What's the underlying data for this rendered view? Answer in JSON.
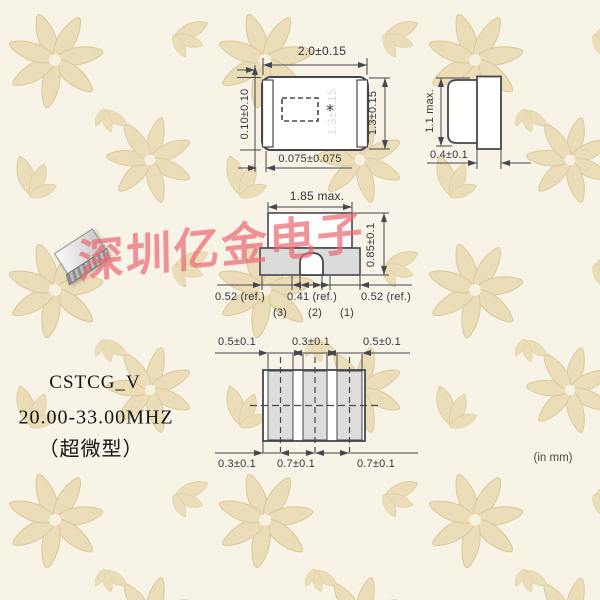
{
  "watermark": {
    "text": "深圳亿金电子",
    "color": "#eb6974"
  },
  "product": {
    "model": "CSTCG_V",
    "frequency": "20.00-33.00MHZ",
    "type_label": "（超微型）"
  },
  "units_note": "(in mm)",
  "top_view": {
    "width": "2.0±0.15",
    "electrode": "0.10±0.10",
    "height": "1.3±0.15",
    "offset": "0.075±0.075",
    "ghost_label": "1.3±0.15",
    "polarity_mark": "*"
  },
  "side_view": {
    "height": "1.1 max.",
    "cap_width": "0.4±0.1"
  },
  "front_view": {
    "width": "1.85 max.",
    "height": "0.85±0.1",
    "pad_left": "0.52 (ref.)",
    "pad_center": "0.41 (ref.)",
    "pad_right": "0.52 (ref.)",
    "pin3": "(3)",
    "pin2": "(2)",
    "pin1": "(1)"
  },
  "land_pattern": {
    "top_left": "0.5±0.1",
    "top_center": "0.3±0.1",
    "top_right": "0.5±0.1",
    "bottom_left": "0.3±0.1",
    "bottom_center": "0.7±0.1",
    "bottom_right": "0.7±0.1"
  },
  "colors": {
    "line": "#46464e",
    "pad_fill": "#dbdbd9",
    "wallpaper_motif": "#e9dbb3"
  }
}
